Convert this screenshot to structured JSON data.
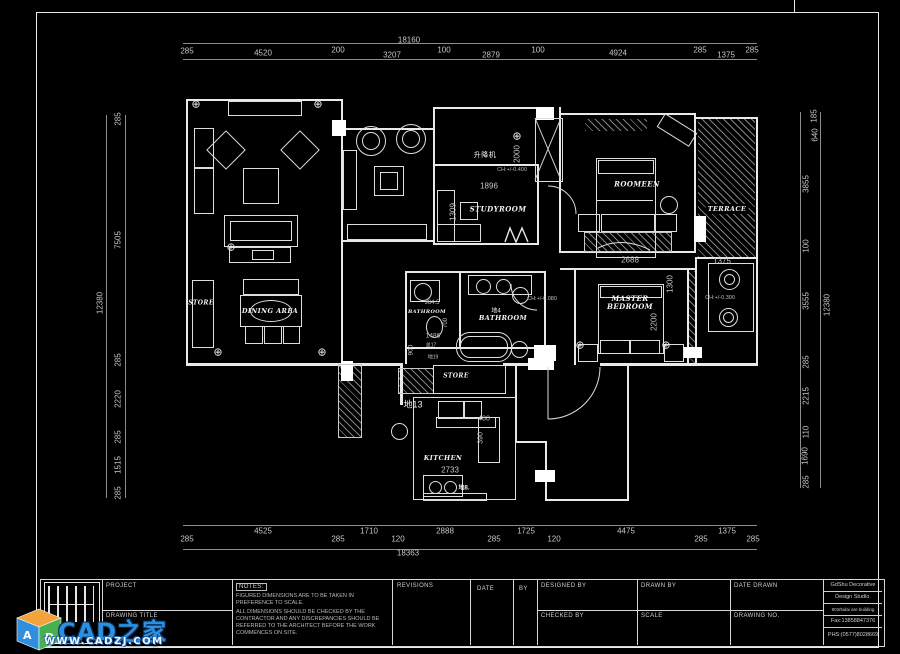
{
  "sheet": {
    "background": "#000000",
    "line_color": "#ffffff",
    "dim_text_color": "#c6c6c6",
    "watermark_blue": "#2d8fe0",
    "cube_orange": "#f2a33c",
    "cube_green": "#49b04f",
    "cube_blue": "#2f8fde"
  },
  "dimensions": {
    "top": {
      "total": "18160",
      "segments": [
        "285",
        "4520",
        "200",
        "3207",
        "100",
        "2879",
        "100",
        "4924",
        "285",
        "1375",
        "285"
      ]
    },
    "bottom": {
      "total": "18363",
      "segments": [
        "285",
        "4525",
        "285",
        "1710",
        "120",
        "2888",
        "285",
        "1725",
        "120",
        "4475",
        "285",
        "1375",
        "285"
      ]
    },
    "left": {
      "total": "12380",
      "segments": [
        "285",
        "7505",
        "285",
        "2220",
        "285",
        "1515",
        "285"
      ]
    },
    "right": {
      "total": "12380",
      "segments": [
        "185",
        "640",
        "3855",
        "100",
        "3555",
        "285",
        "2215",
        "110",
        "1690",
        "285"
      ]
    }
  },
  "rooms": {
    "store_left": "STORE",
    "dining": "DINING AREA",
    "study": "STUDYROOM",
    "elevator": "升降机",
    "bedroom2": "ROOMEEN",
    "terrace": "TERRACE",
    "master_bedroom": "MASTER BEDROOM",
    "bathroom_main": "BATHROOM",
    "bathroom_left": "BATHROOM",
    "store_mid": "STORE",
    "kitchen": "KITCHEN"
  },
  "annotations": {
    "elev_height": "2000",
    "elev_level": "CH:+/-0.400",
    "hall_width": "1896",
    "study_depth": "1309",
    "master_width": "2688",
    "master_d1": "1300",
    "master_d2": "2200",
    "laundry_width": "1375",
    "laundry_level": "CH:+/-0.300",
    "bath_level": "CH:+/-0.080",
    "bath_tag": "地4",
    "bath_left_d1": "984.5",
    "bath_left_d2": "1486",
    "bath_left_d3": "900",
    "bath_note1": "总17",
    "bath_note2": "地19",
    "toilet_width": "700",
    "kitchen_width": "2733",
    "kitchen_d1": "480",
    "kitchen_d2": "390",
    "tag_13": "地13",
    "tag_8": "地8."
  },
  "title_block": {
    "project_label": "PROJECT",
    "drawing_title_label": "DRAWING TITLE",
    "notes_title": "NOTES:",
    "notes_line1": "FIGURED DIMENSIONS ARE TO BE TAKEN IN PREFERENCE TO SCALE.",
    "notes_line2": "ALL DIMENSIONS SHOULD BE CHECKED BY THE CONTRACTOR AND ANY DISCREPANCIES SHOULD BE REFERRED TO THE ARCHITECT BEFORE THE WORK COMMENCES ON SITE.",
    "revisions_label": "REVISIONS",
    "date_label": "DATE",
    "by_label": "BY",
    "designed_by_label": "DESIGNED BY",
    "drawn_by_label": "DRAWN BY",
    "date_drawn_label": "DATE DRAWN",
    "checked_by_label": "CHECKED BY",
    "scale_label": "SCALE",
    "drawing_no_label": "DRAWING NO.",
    "firm_line1": "GdShu Decorative",
    "firm_line2": "Design Studio.",
    "firm_line3": "903/5idai are building",
    "firm_line4": "Fax:13858847376",
    "firm_line5": "PHS:(0577)8028669"
  },
  "watermark": {
    "cube_letter_a": "A",
    "cube_letter_d": "D",
    "brand": "CAD之家",
    "site": "WWW.CADZJ.COM"
  }
}
